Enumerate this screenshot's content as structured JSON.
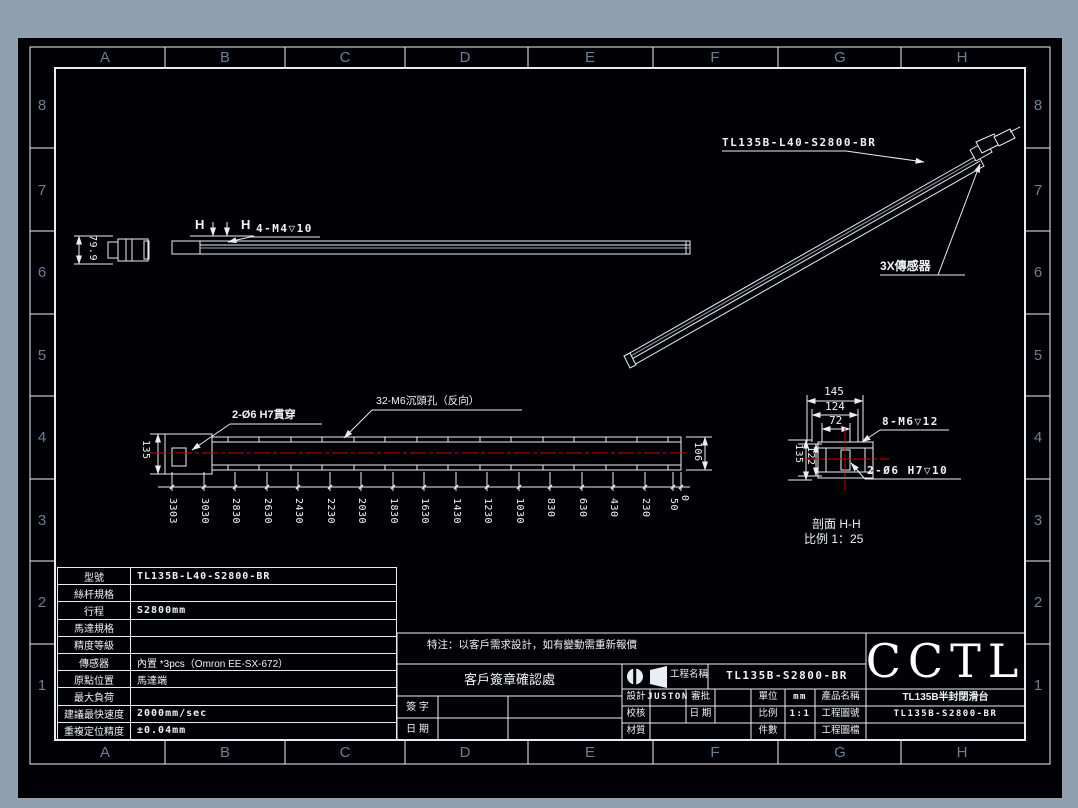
{
  "zones": {
    "top": [
      "A",
      "B",
      "C",
      "D",
      "E",
      "F",
      "G",
      "H"
    ],
    "bottom": [
      "A",
      "B",
      "C",
      "D",
      "E",
      "F",
      "G",
      "H"
    ],
    "left": [
      "8",
      "7",
      "6",
      "5",
      "4",
      "3",
      "2",
      "1"
    ],
    "right": [
      "8",
      "7",
      "6",
      "5",
      "4",
      "3",
      "2",
      "1"
    ]
  },
  "iso_view": {
    "part_label": "TL135B-L40-S2800-BR",
    "sensor_label": "3X傳感器"
  },
  "side_view": {
    "section_letter_left": "H",
    "section_letter_right": "H",
    "thread_label": "4-M4▽10",
    "height_dim": "79.9"
  },
  "plan_view": {
    "hole_label": "2-Ø6 H7貫穿",
    "counterbore_label": "32-M6沉頭孔（反向）",
    "left_dim": "135",
    "right_dim": "106",
    "chain_dims": [
      "3303",
      "3030",
      "2830",
      "2630",
      "2430",
      "2230",
      "2030",
      "1830",
      "1630",
      "1430",
      "1230",
      "1030",
      "830",
      "630",
      "430",
      "230",
      "50",
      "0"
    ]
  },
  "section_view": {
    "top_dims": [
      "145",
      "124",
      "72"
    ],
    "left_dims": [
      "135",
      "122"
    ],
    "thread_label": "8-M6▽12",
    "pin_label": "2-Ø6 H7▽10",
    "caption_title": "剖面 H-H",
    "caption_scale": "比例 1：25"
  },
  "spec_table": {
    "rows": [
      {
        "label": "型號",
        "value": "TL135B-L40-S2800-BR"
      },
      {
        "label": "絲杆規格",
        "value": ""
      },
      {
        "label": "行程",
        "value": "S2800mm"
      },
      {
        "label": "馬達規格",
        "value": ""
      },
      {
        "label": "精度等級",
        "value": ""
      },
      {
        "label": "傳感器",
        "value": "內置 *3pcs（Omron EE-SX-672）"
      },
      {
        "label": "原點位置",
        "value": "馬達端"
      },
      {
        "label": "最大負荷",
        "value": ""
      },
      {
        "label": "建議最快速度",
        "value": "2000mm/sec"
      },
      {
        "label": "重複定位精度",
        "value": "±0.04mm"
      }
    ]
  },
  "note": "特注：以客戶需求設計，如有變動需重新報價",
  "sign_area": {
    "title": "客戶簽章確認處",
    "sign_label": "簽 字",
    "date_label": "日 期"
  },
  "title_block": {
    "project_label": "工程名稱",
    "project_value": "TL135B-S2800-BR",
    "design_label": "設計",
    "design_value": "JUSTON",
    "approve_label": "審批",
    "approve_value": "",
    "check_label": "校核",
    "check_value": "",
    "date_label": "日 期",
    "date_value": "",
    "material_label": "材質",
    "material_value": "",
    "unit_label": "單位",
    "unit_value": "mm",
    "scale_label": "比例",
    "scale_value": "1:1",
    "qty_label": "件數",
    "qty_value": "",
    "product_label": "產品名稱",
    "product_value": "TL135B半封閉滑台",
    "drawing_no_label": "工程圖號",
    "drawing_no_value": "TL135B-S2800-BR",
    "drawing_file_label": "工程圖檔",
    "drawing_file_value": "",
    "logo": "CCTL"
  },
  "colors": {
    "line": "#e9eef5",
    "centerline": "#d40000",
    "desktop": "#8f9fae",
    "canvas": "#020206",
    "zone_label": "#6c7e95"
  }
}
